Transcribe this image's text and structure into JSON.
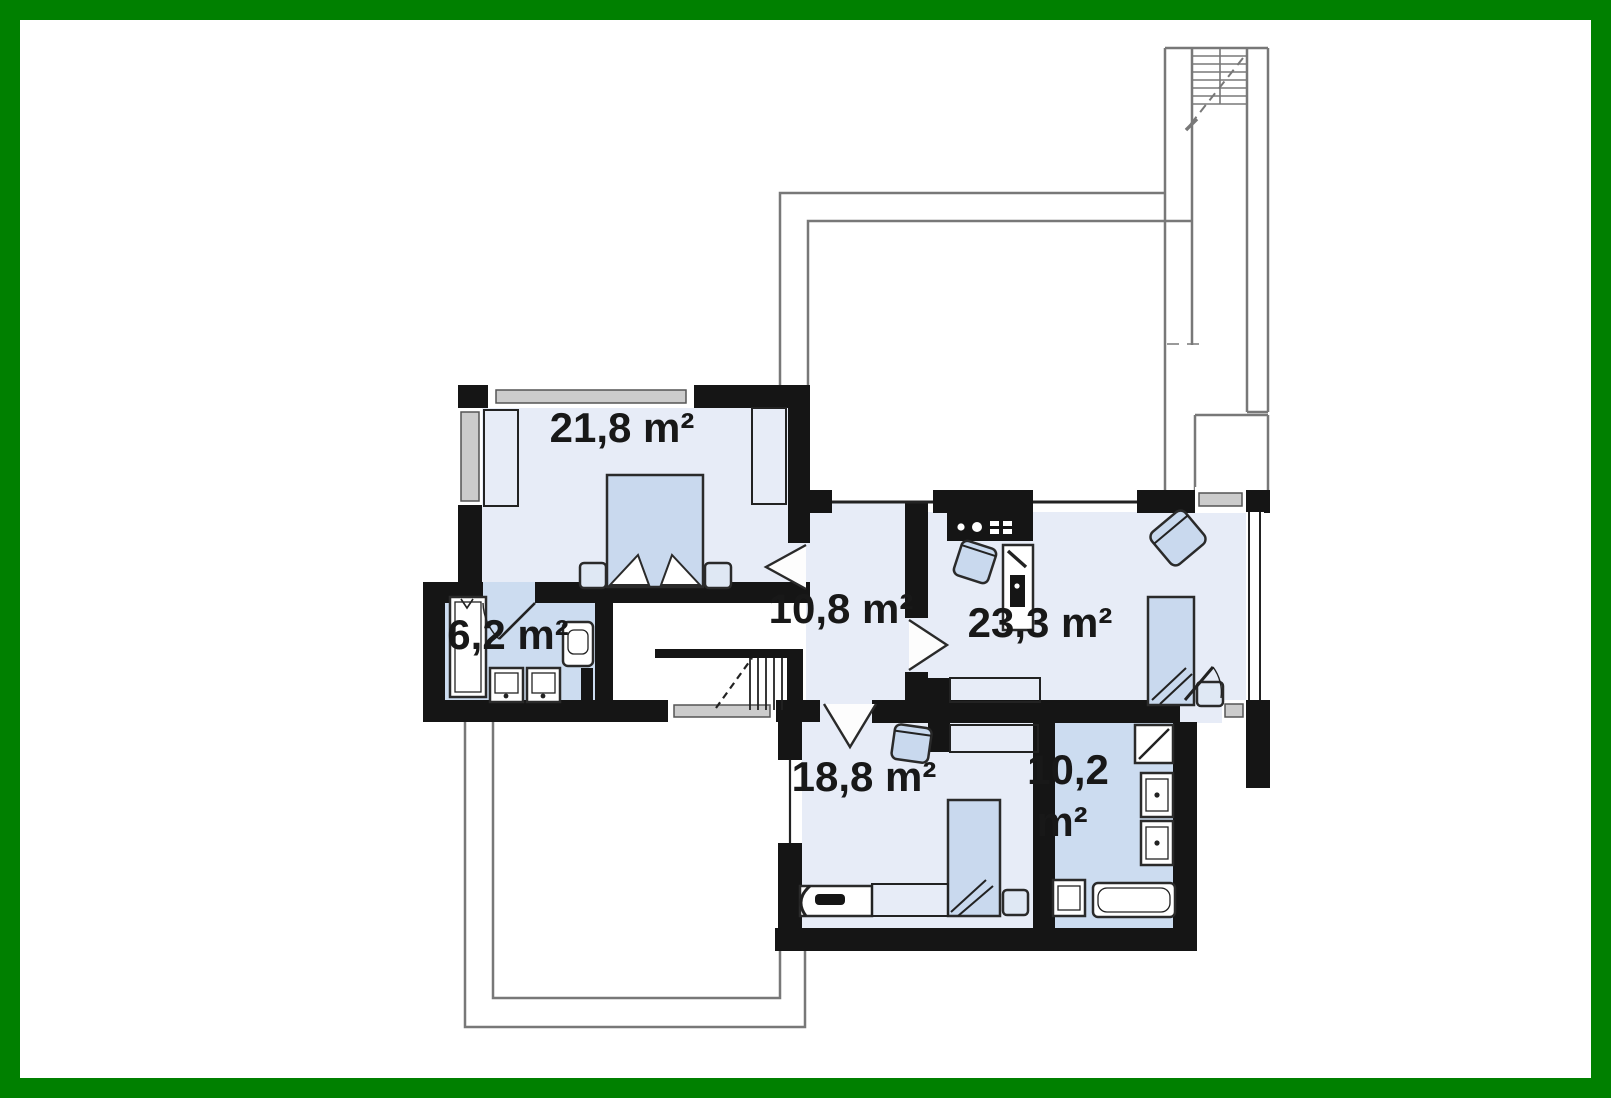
{
  "page": {
    "kind": "architectural floor plan, upper storey"
  },
  "plan": {
    "rooms": [
      {
        "name": "bedroom-top-left",
        "area": "21,8 m²"
      },
      {
        "name": "ensuite-bathroom",
        "area": "6,2 m²"
      },
      {
        "name": "hall-staircase",
        "area": "10,8 m²"
      },
      {
        "name": "bedroom-right",
        "area": "23,3 m²"
      },
      {
        "name": "bedroom-bottom",
        "area": "18,8 m²"
      },
      {
        "name": "bathroom-bottom",
        "area_line1": "10,2",
        "area_line2": "m²"
      }
    ],
    "colors": {
      "frame": "#008000",
      "wall": "#151515",
      "room_floor": "#e7ecf7",
      "bath_floor": "#ccdcf0",
      "furniture": "#c9d9ee",
      "window": "#cccccc",
      "outline": "#787878"
    }
  }
}
